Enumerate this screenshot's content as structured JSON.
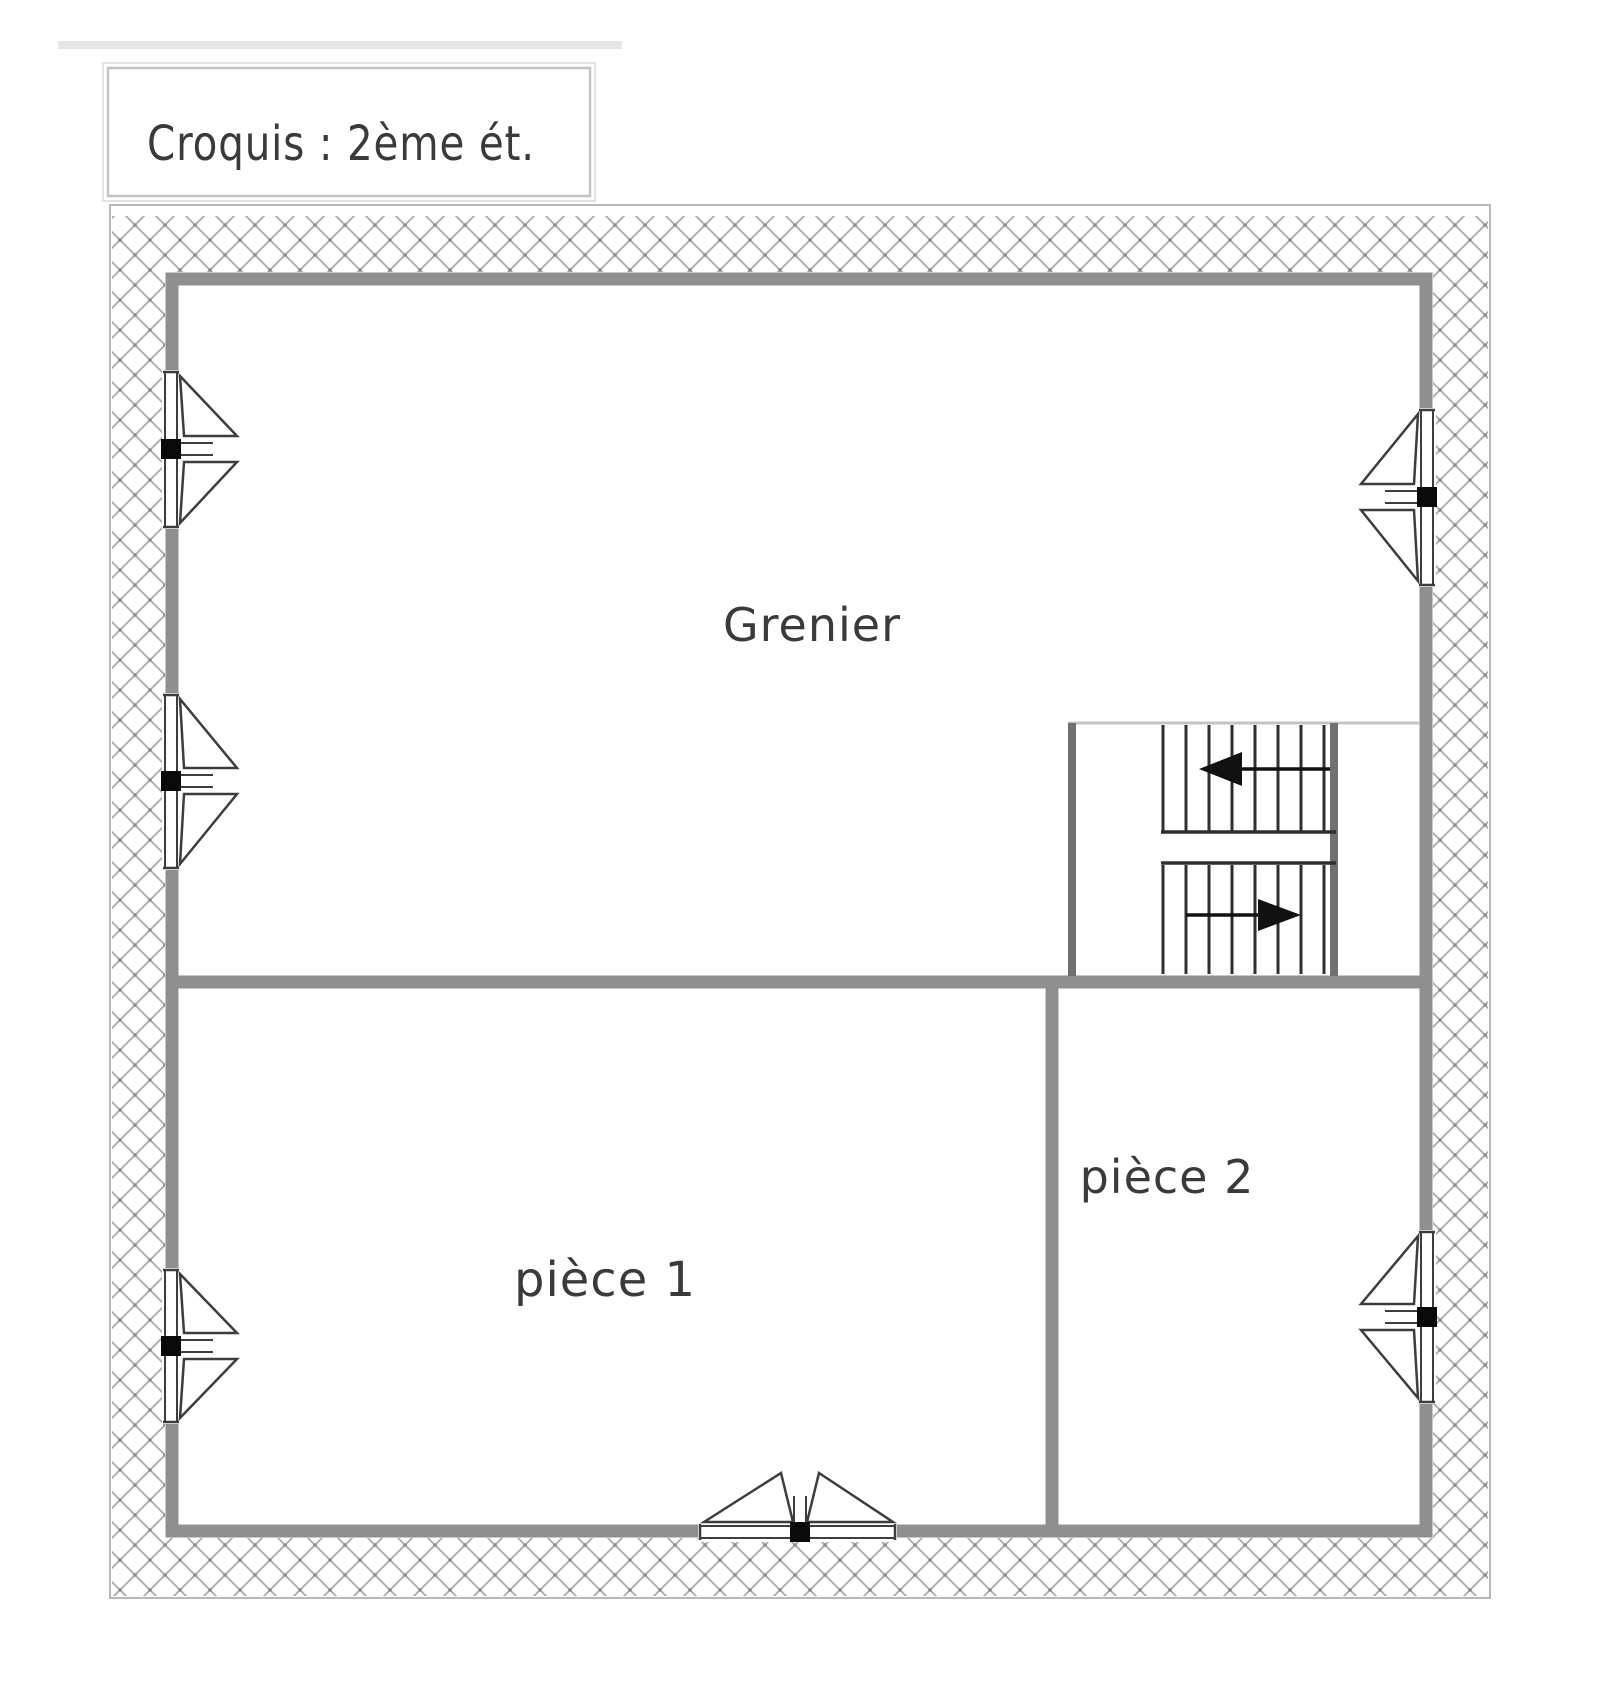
{
  "title": {
    "text": "Croquis : 2ème ét."
  },
  "plan": {
    "room_labels": {
      "grenier": "Grenier",
      "piece1": "pièce 1",
      "piece2": "pièce 2"
    },
    "colors": {
      "background": "#ffffff",
      "wall_gray": "#8f8f8f",
      "hatch_gray": "#b0b0b0",
      "outline_gray": "#b8b8b8",
      "detail_dark": "#333333",
      "window_black_square": "#0a0a0a",
      "label_text": "#3a3a3a"
    },
    "icons": [
      "window-icon (x6: 3 left wall, 2 right wall, 1 bottom wall)",
      "staircase-icon (two flights, middle landing)",
      "stair-arrow-left-icon",
      "stair-arrow-right-icon"
    ]
  }
}
